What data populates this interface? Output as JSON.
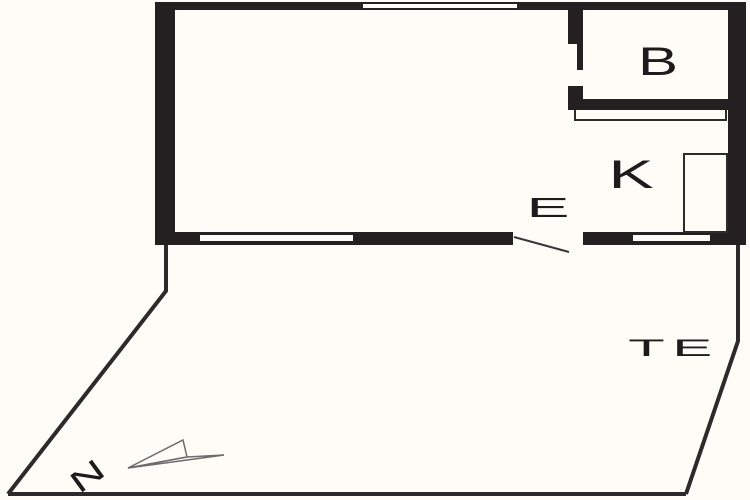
{
  "floorplan": {
    "type": "architectural-floor-plan",
    "rooms": {
      "b": {
        "label": "B"
      },
      "k": {
        "label": "K"
      },
      "e": {
        "label": "E"
      },
      "te": {
        "label": "TE"
      }
    },
    "compass": {
      "label": "N"
    },
    "colors": {
      "wall": "#241f20",
      "background": "#fdfcf7",
      "line": "#2d2a2b",
      "arrow_outline": "#6b6b6b",
      "text": "#1e1b1c"
    }
  }
}
